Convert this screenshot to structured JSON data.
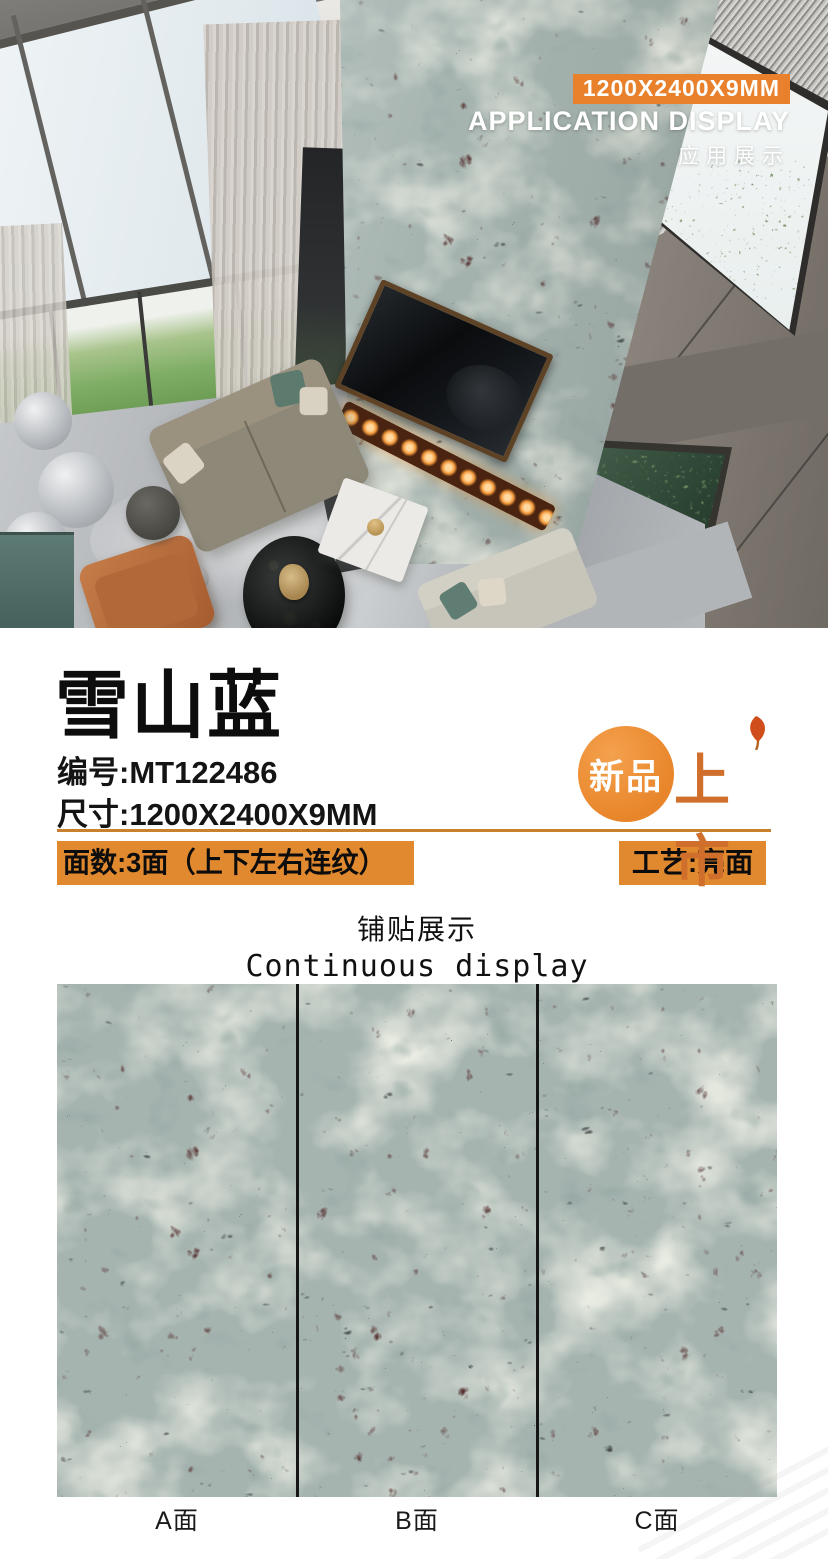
{
  "photo_overlay": {
    "size_badge": "1200X2400X9MM",
    "app_display_en": "APPLICATION DISPLAY",
    "app_display_cn": "应用展示"
  },
  "product": {
    "name": "雪山蓝",
    "code_label": "编号:",
    "code_value": "MT122486",
    "dim_label": "尺寸:",
    "dim_value": "1200X2400X9MM",
    "faces_bar": "面数:3面（上下左右连纹）",
    "finish_bar": "工艺:亮面",
    "new_badge_circle": "新品",
    "new_badge_side": "上市"
  },
  "tiling": {
    "heading_cn": "铺贴展示",
    "heading_en": "Continuous display",
    "panel_labels": [
      "A面",
      "B面",
      "C面"
    ]
  },
  "colors": {
    "accent_orange": "#e0892f",
    "underline_orange": "#c8822f",
    "overlay_badge_orange": "#e8802c",
    "marble_base": "#a6b4b0",
    "divider_black": "#161616"
  }
}
